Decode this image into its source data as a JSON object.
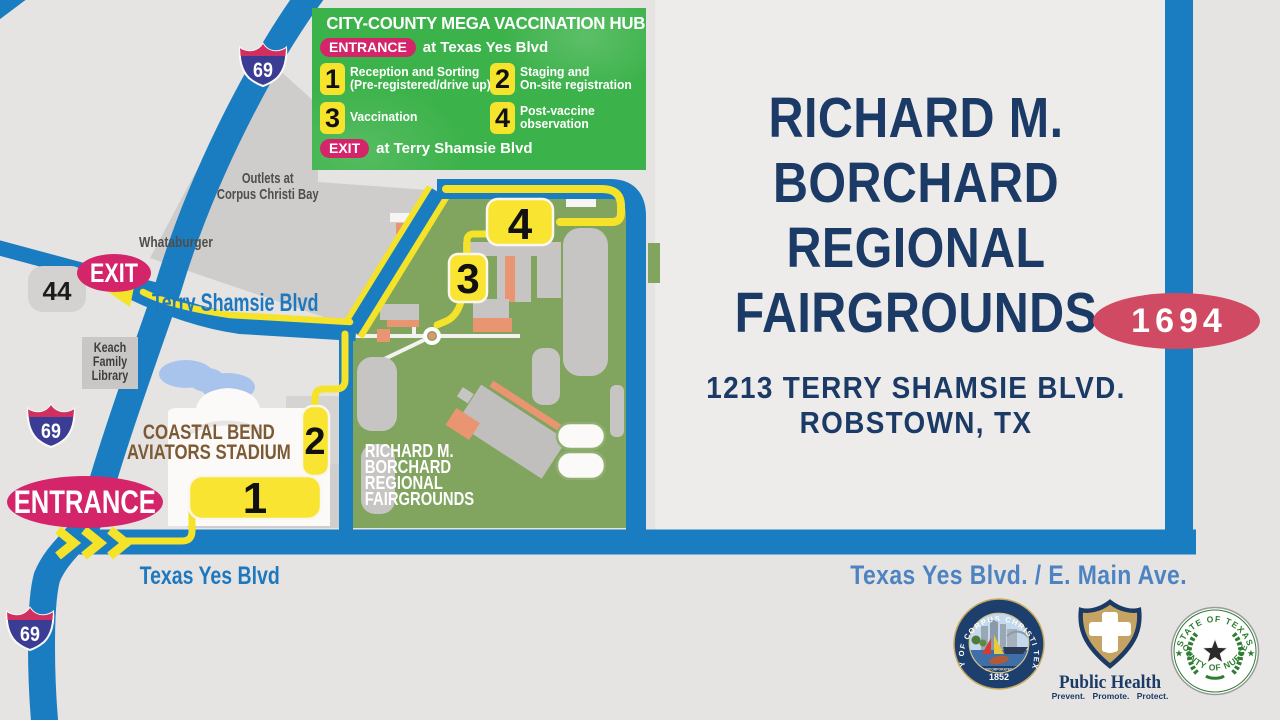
{
  "info_box": {
    "title": "CITY-COUNTY MEGA VACCINATION HUB",
    "entrance_badge": "ENTRANCE",
    "entrance_text": "at Texas Yes Blvd",
    "exit_badge": "EXIT",
    "exit_text": "at Terry Shamsie Blvd",
    "steps": [
      {
        "num": "1",
        "line1": "Reception and Sorting",
        "line2": "(Pre-registered/drive up)"
      },
      {
        "num": "2",
        "line1": "Staging and",
        "line2": "On-site registration"
      },
      {
        "num": "3",
        "line1": "Vaccination",
        "line2": ""
      },
      {
        "num": "4",
        "line1": "Post-vaccine",
        "line2": "observation"
      }
    ]
  },
  "map": {
    "interstate_number": "69",
    "highway_number": "44",
    "exit_badge": "EXIT",
    "entrance_badge": "ENTRANCE",
    "stations": [
      "1",
      "2",
      "3",
      "4"
    ],
    "labels": {
      "outlets_line1": "Outlets at",
      "outlets_line2": "Corpus Christi Bay",
      "whataburger": "Whataburger",
      "keach_line1": "Keach",
      "keach_line2": "Family",
      "keach_line3": "Library",
      "terry_shamsie": "Terry Shamsie Blvd",
      "texas_yes": "Texas Yes Blvd",
      "stadium_line1": "COASTAL BEND",
      "stadium_line2": "AVIATORS STADIUM",
      "fairgrounds_line1": "RICHARD M.",
      "fairgrounds_line2": "BORCHARD",
      "fairgrounds_line3": "REGIONAL",
      "fairgrounds_line4": "FAIRGROUNDS"
    }
  },
  "panel": {
    "title_line1": "RICHARD M.",
    "title_line2": "BORCHARD",
    "title_line3": "REGIONAL",
    "title_line4": "FAIRGROUNDS",
    "address_line1": "1213 TERRY SHAMSIE BLVD.",
    "address_line2": "ROBSTOWN, TX",
    "route_badge": "1694",
    "road_label": "Texas Yes Blvd. / E. Main Ave."
  },
  "logos": {
    "corpus_seal": {
      "ring_text": "CITY OF CORPUS CHRISTI TEXAS",
      "incorporated": "INCORPORATED",
      "year": "1852"
    },
    "public_health": {
      "name": "Public Health",
      "tagline": "Prevent. Promote. Protect."
    },
    "nueces_seal": {
      "top_text": "STATE OF TEXAS",
      "bottom_text": "COUNTY OF NUECES"
    }
  },
  "colors": {
    "road_blue": "#1a7dc2",
    "route_yellow": "#f4e328",
    "badge_pink": "#d4256b",
    "panel_navy": "#1b3a66",
    "fairground_green": "#81a45f",
    "hub_green": "#3cb24a",
    "route_marker_red": "#d04a63"
  }
}
